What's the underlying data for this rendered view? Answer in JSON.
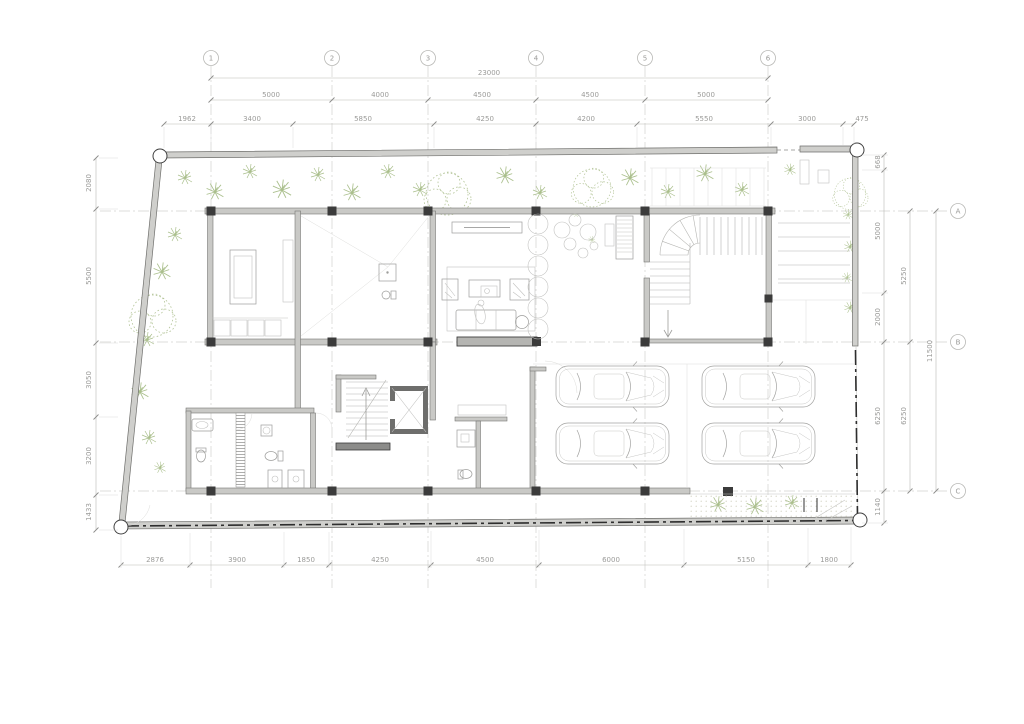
{
  "drawing": {
    "type": "architectural ground floor plan",
    "colors": {
      "background": "#ffffff",
      "wall_fill": "#c9c9c6",
      "column": "#3b3b3b",
      "dimension": "#9b9b99",
      "planting": "#aabf8c",
      "property_line": "#2e2e2e"
    },
    "grid": {
      "cols": [
        "1",
        "2",
        "3",
        "4",
        "5",
        "6"
      ],
      "rows": [
        "A",
        "B",
        "C"
      ]
    },
    "dims": {
      "top_total": "23000",
      "top_segments": [
        "5000",
        "4000",
        "4500",
        "4500",
        "5000"
      ],
      "top_detail": [
        "1962",
        "3400",
        "5850",
        "4250",
        "4200",
        "5550",
        "3000",
        "475"
      ],
      "left": [
        "2080",
        "5500",
        "3050",
        "3200",
        "1433"
      ],
      "right_inner": [
        "668",
        "5000",
        "2000",
        "6250",
        "1140"
      ],
      "right_mid": [
        "5250",
        "6250"
      ],
      "right_total": "11500",
      "bottom": [
        "2876",
        "3900",
        "1850",
        "4250",
        "4500",
        "6000",
        "5150",
        "1800"
      ]
    }
  }
}
